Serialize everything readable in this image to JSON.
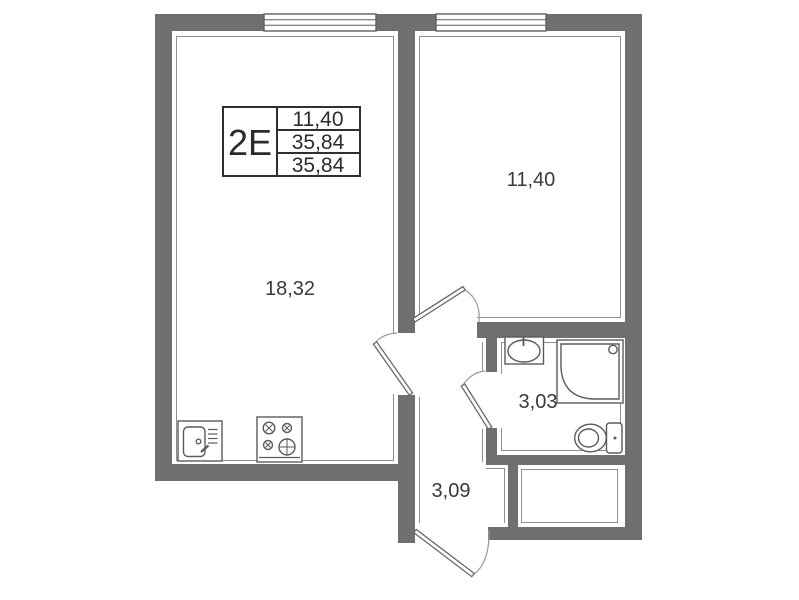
{
  "title_block": {
    "unit_type": "2Е",
    "area_values": {
      "row1": "11,40",
      "row2": "35,84",
      "row3": "35,84"
    }
  },
  "room_labels": {
    "living_kitchen": "18,32",
    "bedroom": "11,40",
    "bathroom": "3,03",
    "hallway": "3,09"
  },
  "icons": [
    "kitchen-sink-icon",
    "stove-icon",
    "washbasin-icon",
    "shower-cabin-icon",
    "toilet-icon",
    "window-icon",
    "door-leaf-icon",
    "door-swing-arc-icon"
  ],
  "colors": {
    "wall_fill": "#6f6f6f",
    "room_outline": "#8f8f8f",
    "fixture_stroke": "#5a5a5a",
    "label_text": "#3a3a3a",
    "table_border": "#2f2f2f",
    "background": "#ffffff"
  }
}
